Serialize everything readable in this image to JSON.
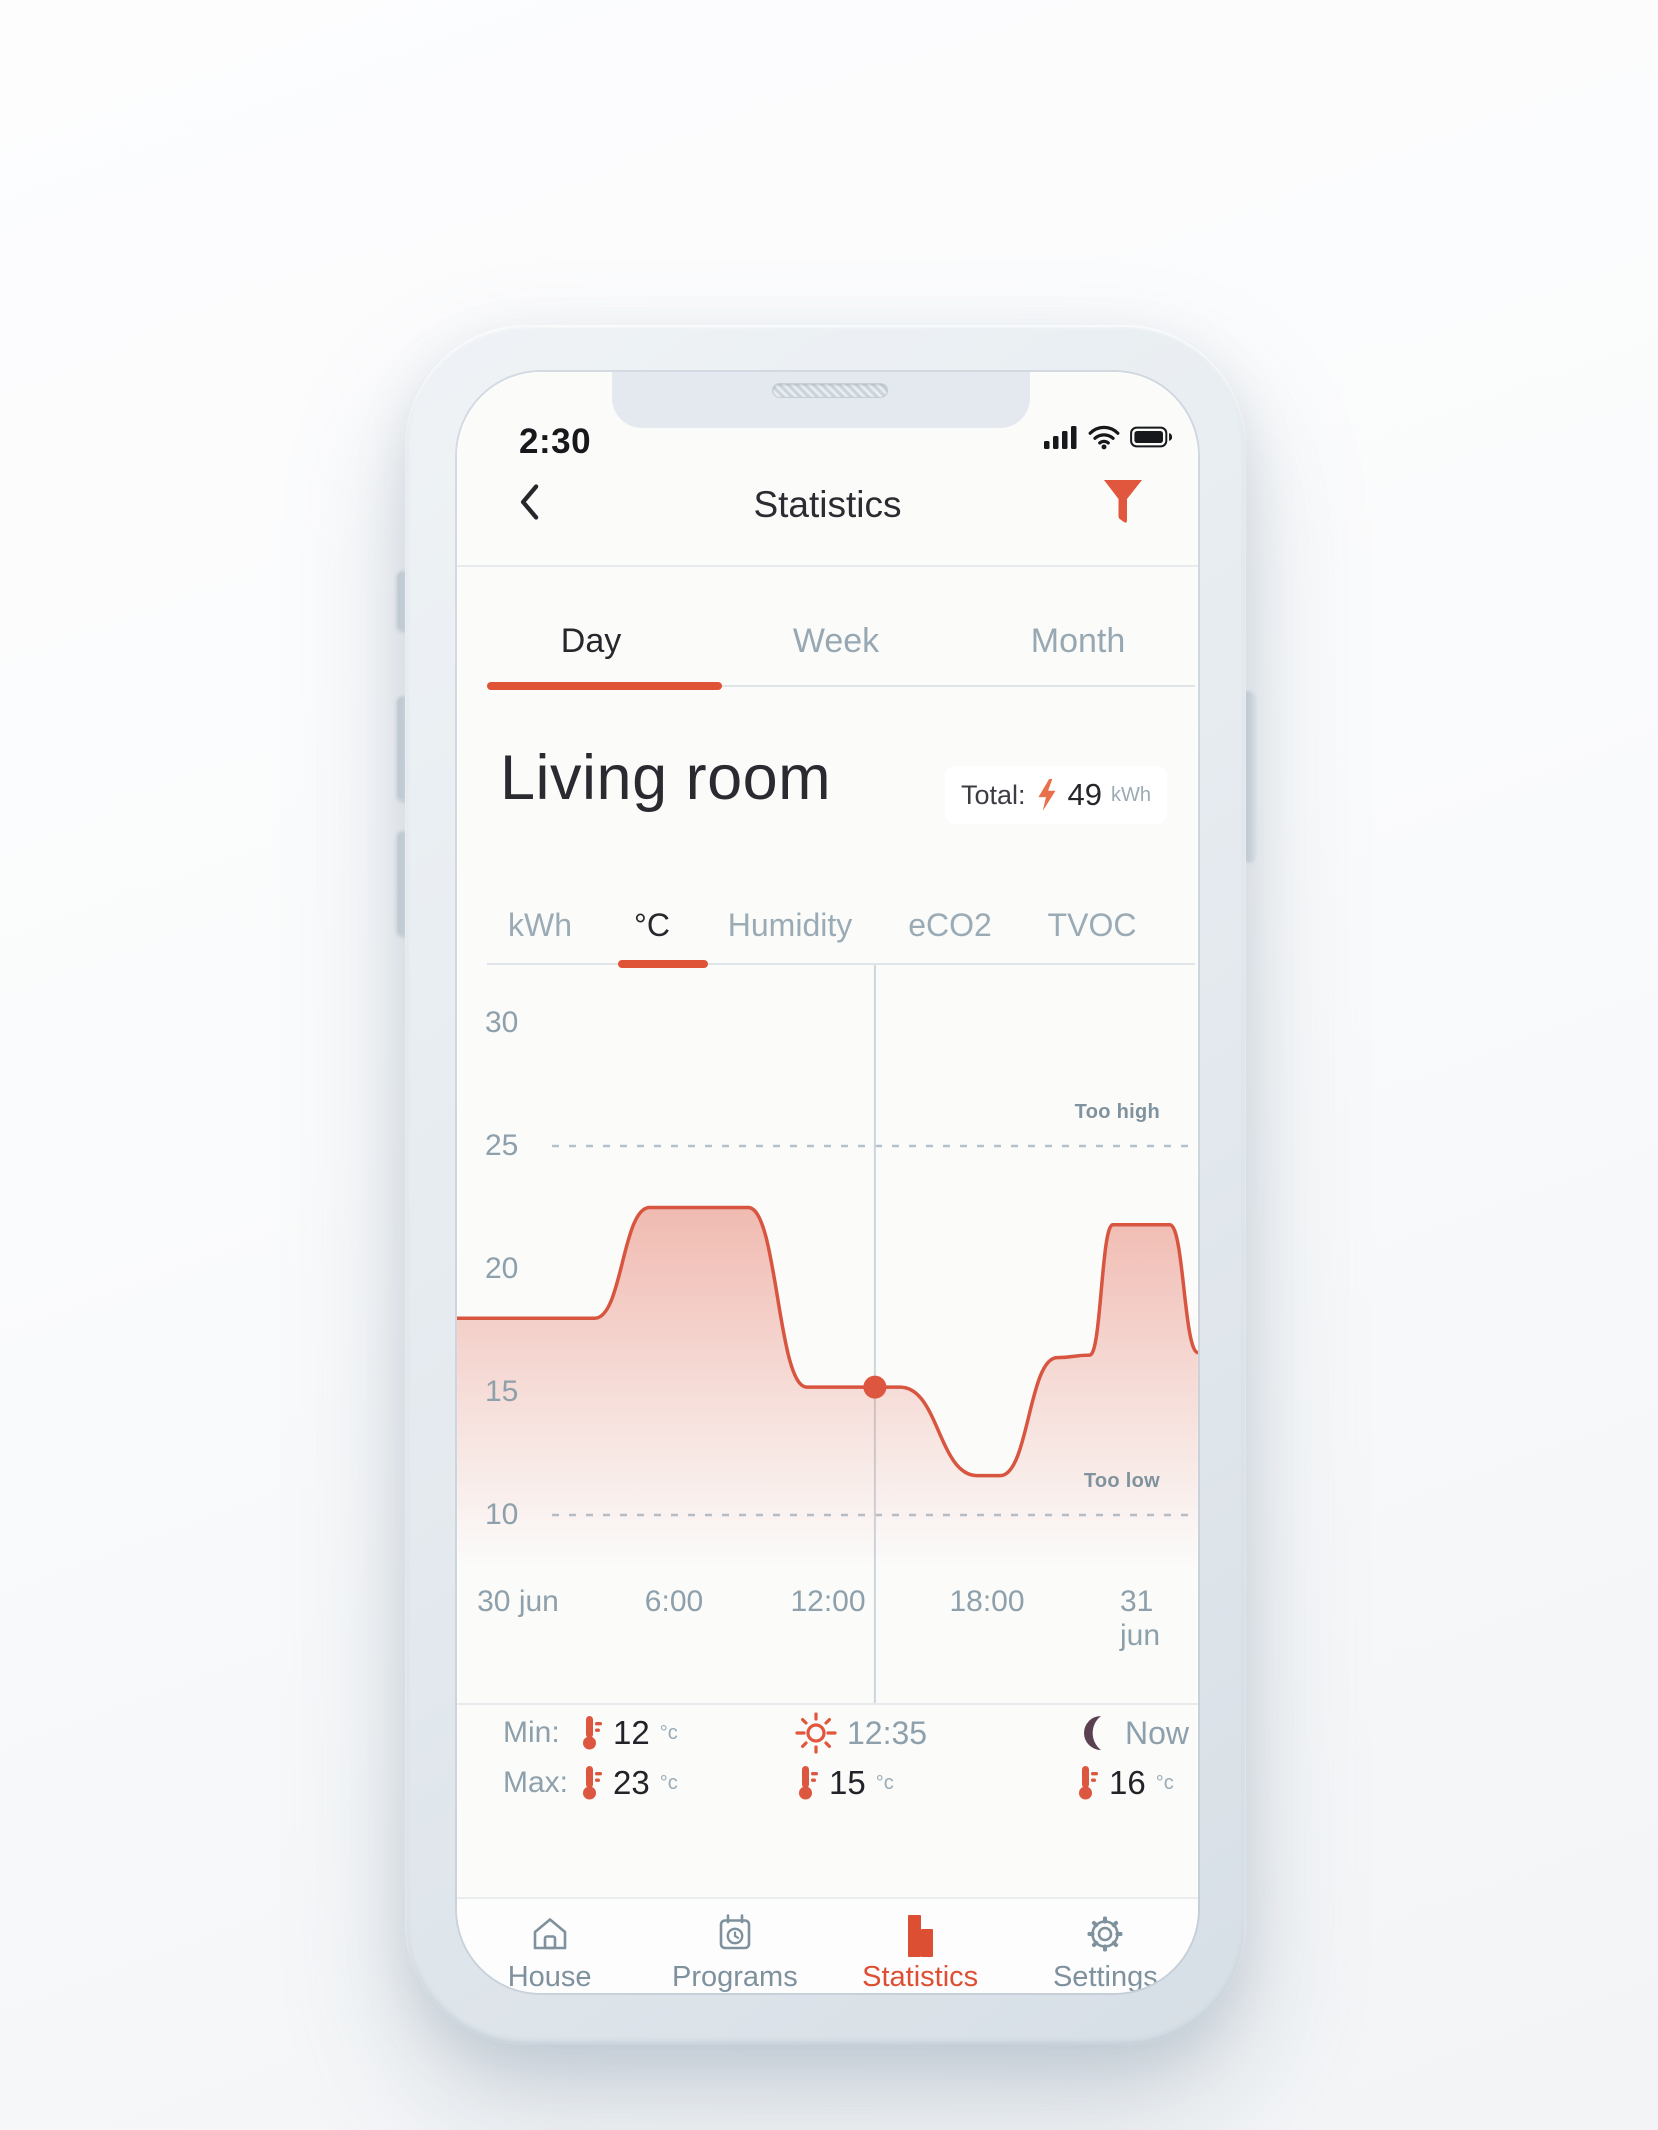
{
  "status_bar": {
    "time": "2:30"
  },
  "header": {
    "title": "Statistics"
  },
  "period_tabs": [
    {
      "label": "Day",
      "active": true
    },
    {
      "label": "Week",
      "active": false
    },
    {
      "label": "Month",
      "active": false
    }
  ],
  "room": {
    "title": "Living room",
    "total_label": "Total:",
    "total_value": "49",
    "total_unit": "kWh"
  },
  "metric_tabs": [
    {
      "label": "kWh",
      "active": false
    },
    {
      "label": "°C",
      "active": true
    },
    {
      "label": "Humidity",
      "active": false
    },
    {
      "label": "eCO2",
      "active": false
    },
    {
      "label": "TVOC",
      "active": false
    }
  ],
  "chart_data": {
    "type": "area",
    "unit": "°C",
    "ylim": [
      8,
      32
    ],
    "y_ticks": [
      30,
      25,
      20,
      15,
      10
    ],
    "grid": "dashed-thresholds-only",
    "legend": "none",
    "thresholds": {
      "too_high": {
        "value": 25,
        "label": "Too high"
      },
      "too_low": {
        "value": 10,
        "label": "Too low"
      }
    },
    "x_ticks": [
      {
        "label": "30 jun",
        "f": 0.082
      },
      {
        "label": "6:00",
        "f": 0.293
      },
      {
        "label": "12:00",
        "f": 0.501
      },
      {
        "label": "18:00",
        "f": 0.715
      },
      {
        "label": "31 jun",
        "f": 0.93
      }
    ],
    "now_marker": {
      "f": 0.564,
      "temp": 15.2
    },
    "series": [
      {
        "name": "temperature",
        "points": [
          [
            0.0,
            18.0
          ],
          [
            0.186,
            18.0
          ],
          [
            0.26,
            22.5
          ],
          [
            0.393,
            22.5
          ],
          [
            0.472,
            15.2
          ],
          [
            0.598,
            15.2
          ],
          [
            0.702,
            11.6
          ],
          [
            0.733,
            11.6
          ],
          [
            0.81,
            16.4
          ],
          [
            0.854,
            16.5
          ],
          [
            0.885,
            21.8
          ],
          [
            0.962,
            21.8
          ],
          [
            1.0,
            16.6
          ]
        ]
      }
    ],
    "line_color": "#d85540",
    "fill_color": "#e05a44",
    "marker_color": "#dd5640"
  },
  "stats": {
    "min": {
      "label": "Min:",
      "value": "12",
      "unit": "°c"
    },
    "max": {
      "label": "Max:",
      "value": "23",
      "unit": "°c"
    },
    "midday": {
      "time": "12:35",
      "value": "15",
      "unit": "°c"
    },
    "now": {
      "label": "Now",
      "value": "16",
      "unit": "°c"
    }
  },
  "nav": [
    {
      "label": "House",
      "active": false
    },
    {
      "label": "Programs",
      "active": false
    },
    {
      "label": "Statistics",
      "active": true
    },
    {
      "label": "Settings",
      "active": false
    }
  ],
  "colors": {
    "accent": "#e0573d",
    "text_dark": "#2a2a31",
    "text_gray": "#8da0ab",
    "moon": "#5a4050",
    "nav_inactive": "#7e919d"
  }
}
